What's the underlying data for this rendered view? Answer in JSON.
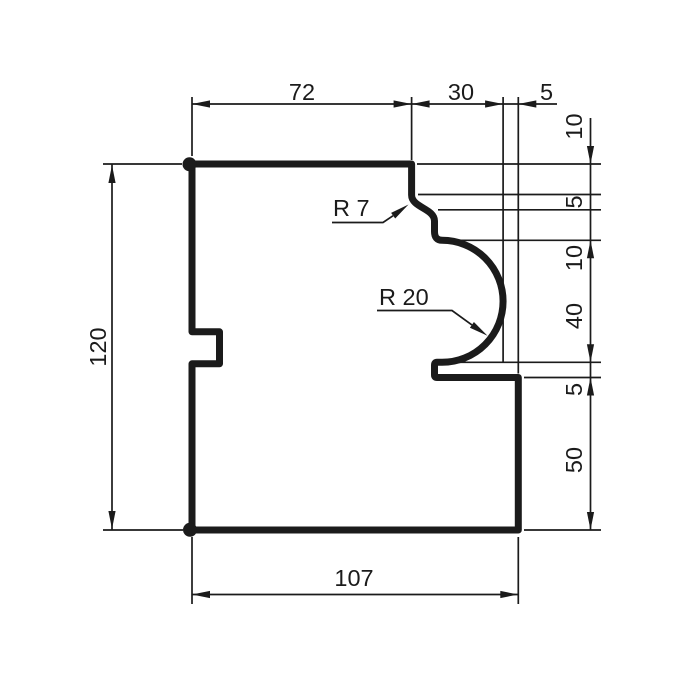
{
  "colors": {
    "ink": "#1b1b1b",
    "paper": "#ffffff"
  },
  "drawing": {
    "dims": {
      "top": {
        "w72": "72",
        "w30": "30",
        "w5": "5"
      },
      "right": {
        "h10a": "10",
        "h5a": "5",
        "h10b": "10",
        "h40": "40",
        "h5b": "5",
        "h50": "50"
      },
      "left": {
        "h120": "120"
      },
      "bottom": {
        "w107": "107"
      }
    },
    "radii": {
      "r7": "R 7",
      "r20": "R 20"
    }
  }
}
